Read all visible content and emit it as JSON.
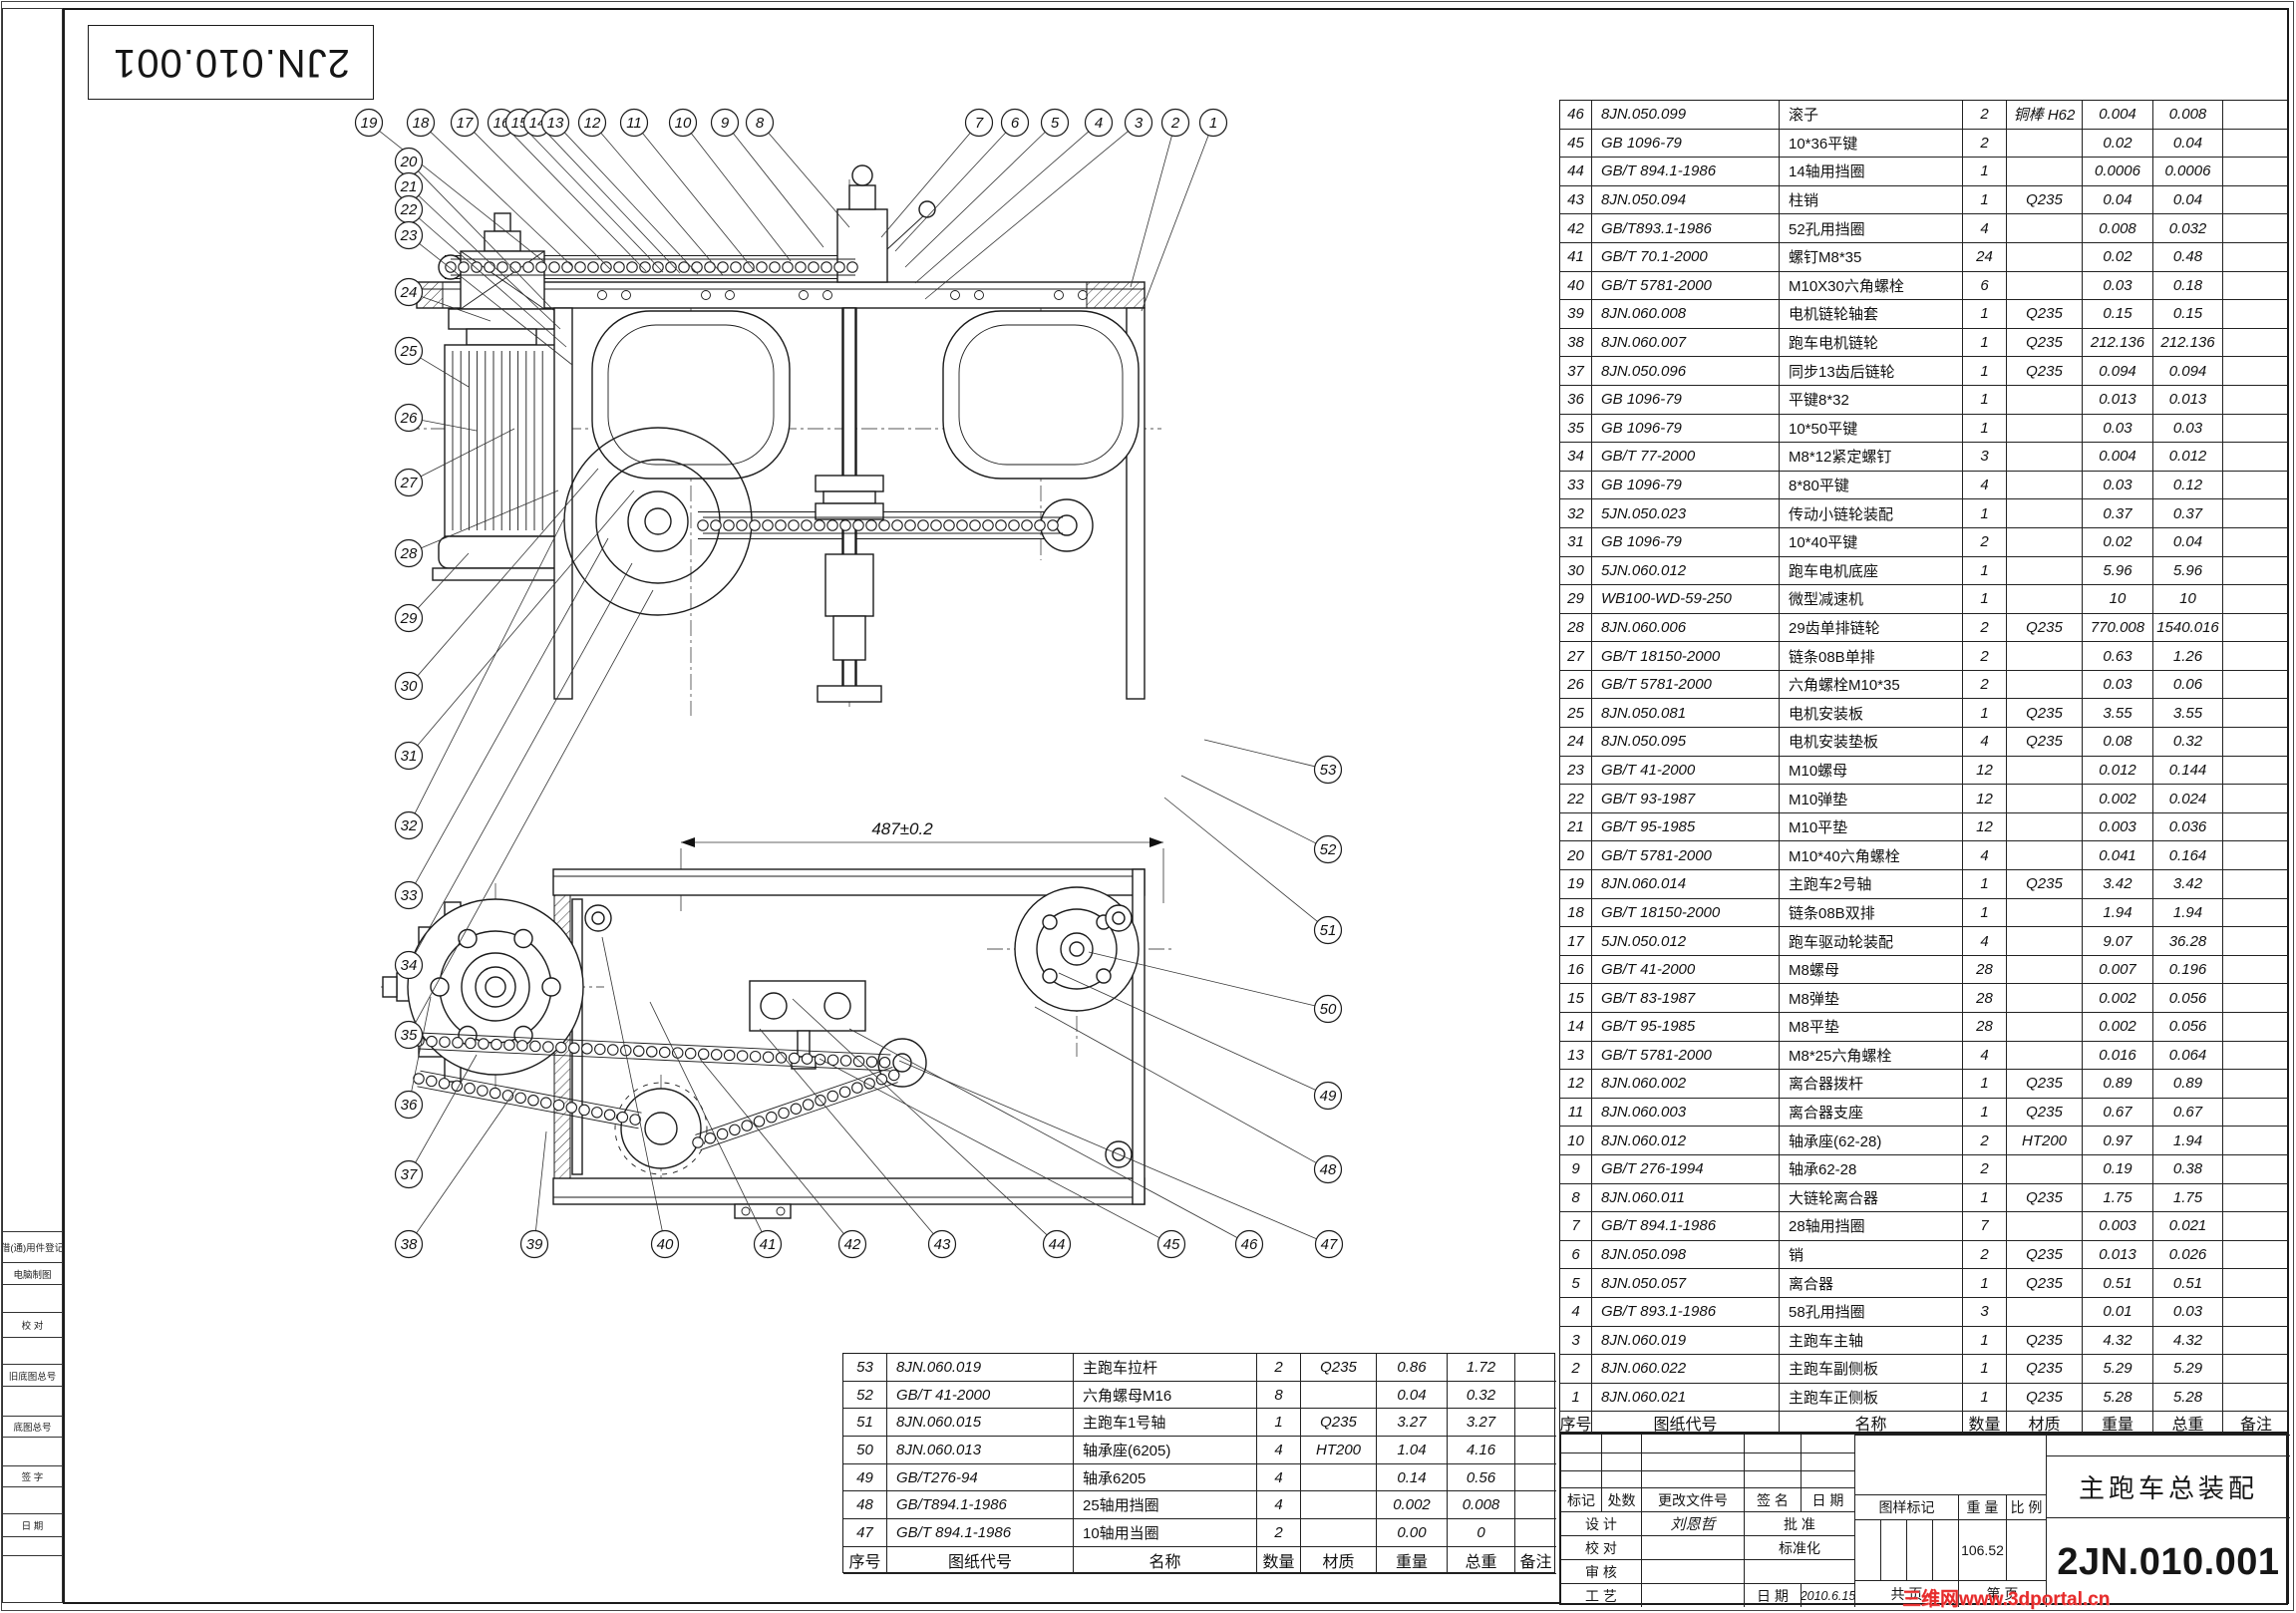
{
  "sheet": {
    "top_left_code": "2JN.010.001",
    "watermark": "三维网www.3dportal.cn"
  },
  "left_margin": {
    "cells": [
      "",
      "借(通)用件登记",
      "电脑制图",
      "",
      "校  对",
      "",
      "旧底图总号",
      "",
      "底图总号",
      "",
      "签  字",
      "",
      "日  期",
      "",
      ""
    ]
  },
  "bom_header": [
    "序号",
    "图纸代号",
    "名称",
    "数量",
    "材质",
    "重量",
    "总重",
    "备注"
  ],
  "bom_right": [
    [
      "46",
      "8JN.050.099",
      "滚子",
      "2",
      "铜棒 H62",
      "0.004",
      "0.008"
    ],
    [
      "45",
      "GB 1096-79",
      "10*36平键",
      "2",
      "",
      "0.02",
      "0.04"
    ],
    [
      "44",
      "GB/T 894.1-1986",
      "14轴用挡圈",
      "1",
      "",
      "0.0006",
      "0.0006"
    ],
    [
      "43",
      "8JN.050.094",
      "柱销",
      "1",
      "Q235",
      "0.04",
      "0.04"
    ],
    [
      "42",
      "GB/T893.1-1986",
      "52孔用挡圈",
      "4",
      "",
      "0.008",
      "0.032"
    ],
    [
      "41",
      "GB/T 70.1-2000",
      "螺钉M8*35",
      "24",
      "",
      "0.02",
      "0.48"
    ],
    [
      "40",
      "GB/T 5781-2000",
      "M10X30六角螺栓",
      "6",
      "",
      "0.03",
      "0.18"
    ],
    [
      "39",
      "8JN.060.008",
      "电机链轮轴套",
      "1",
      "Q235",
      "0.15",
      "0.15"
    ],
    [
      "38",
      "8JN.060.007",
      "跑车电机链轮",
      "1",
      "Q235",
      "212.136",
      "212.136"
    ],
    [
      "37",
      "8JN.050.096",
      "同步13齿后链轮",
      "1",
      "Q235",
      "0.094",
      "0.094"
    ],
    [
      "36",
      "GB  1096-79",
      "平键8*32",
      "1",
      "",
      "0.013",
      "0.013"
    ],
    [
      "35",
      "GB 1096-79",
      "10*50平键",
      "1",
      "",
      "0.03",
      "0.03"
    ],
    [
      "34",
      "GB/T 77-2000",
      "M8*12紧定螺钉",
      "3",
      "",
      "0.004",
      "0.012"
    ],
    [
      "33",
      "GB 1096-79",
      "8*80平键",
      "4",
      "",
      "0.03",
      "0.12"
    ],
    [
      "32",
      "5JN.050.023",
      "传动小链轮装配",
      "1",
      "",
      "0.37",
      "0.37"
    ],
    [
      "31",
      "GB 1096-79",
      "10*40平键",
      "2",
      "",
      "0.02",
      "0.04"
    ],
    [
      "30",
      "5JN.060.012",
      "跑车电机底座",
      "1",
      "",
      "5.96",
      "5.96"
    ],
    [
      "29",
      "WB100-WD-59-250",
      "微型减速机",
      "1",
      "",
      "10",
      "10"
    ],
    [
      "28",
      "8JN.060.006",
      "29齿单排链轮",
      "2",
      "Q235",
      "770.008",
      "1540.016"
    ],
    [
      "27",
      "GB/T 18150-2000",
      "链条08B单排",
      "2",
      "",
      "0.63",
      "1.26"
    ],
    [
      "26",
      "GB/T 5781-2000",
      "六角螺栓M10*35",
      "2",
      "",
      "0.03",
      "0.06"
    ],
    [
      "25",
      "8JN.050.081",
      "电机安装板",
      "1",
      "Q235",
      "3.55",
      "3.55"
    ],
    [
      "24",
      "8JN.050.095",
      "电机安装垫板",
      "4",
      "Q235",
      "0.08",
      "0.32"
    ],
    [
      "23",
      "GB/T 41-2000",
      "M10螺母",
      "12",
      "",
      "0.012",
      "0.144"
    ],
    [
      "22",
      "GB/T 93-1987",
      "M10弹垫",
      "12",
      "",
      "0.002",
      "0.024"
    ],
    [
      "21",
      "GB/T 95-1985",
      "M10平垫",
      "12",
      "",
      "0.003",
      "0.036"
    ],
    [
      "20",
      "GB/T 5781-2000",
      "M10*40六角螺栓",
      "4",
      "",
      "0.041",
      "0.164"
    ],
    [
      "19",
      "8JN.060.014",
      "主跑车2号轴",
      "1",
      "Q235",
      "3.42",
      "3.42"
    ],
    [
      "18",
      "GB/T 18150-2000",
      "链条08B双排",
      "1",
      "",
      "1.94",
      "1.94"
    ],
    [
      "17",
      "5JN.050.012",
      "跑车驱动轮装配",
      "4",
      "",
      "9.07",
      "36.28"
    ],
    [
      "16",
      "GB/T 41-2000",
      "M8螺母",
      "28",
      "",
      "0.007",
      "0.196"
    ],
    [
      "15",
      "GB/T 83-1987",
      "M8弹垫",
      "28",
      "",
      "0.002",
      "0.056"
    ],
    [
      "14",
      "GB/T 95-1985",
      "M8平垫",
      "28",
      "",
      "0.002",
      "0.056"
    ],
    [
      "13",
      "GB/T 5781-2000",
      "M8*25六角螺栓",
      "4",
      "",
      "0.016",
      "0.064"
    ],
    [
      "12",
      "8JN.060.002",
      "离合器拨杆",
      "1",
      "Q235",
      "0.89",
      "0.89"
    ],
    [
      "11",
      "8JN.060.003",
      "离合器支座",
      "1",
      "Q235",
      "0.67",
      "0.67"
    ],
    [
      "10",
      "8JN.060.012",
      "轴承座(62-28)",
      "2",
      "HT200",
      "0.97",
      "1.94"
    ],
    [
      "9",
      "GB/T 276-1994",
      "轴承62-28",
      "2",
      "",
      "0.19",
      "0.38"
    ],
    [
      "8",
      "8JN.060.011",
      "大链轮离合器",
      "1",
      "Q235",
      "1.75",
      "1.75"
    ],
    [
      "7",
      "GB/T 894.1-1986",
      "28轴用挡圈",
      "7",
      "",
      "0.003",
      "0.021"
    ],
    [
      "6",
      "8JN.050.098",
      "销",
      "2",
      "Q235",
      "0.013",
      "0.026"
    ],
    [
      "5",
      "8JN.050.057",
      "离合器",
      "1",
      "Q235",
      "0.51",
      "0.51"
    ],
    [
      "4",
      "GB/T 893.1-1986",
      "58孔用挡圈",
      "3",
      "",
      "0.01",
      "0.03"
    ],
    [
      "3",
      "8JN.060.019",
      "主跑车主轴",
      "1",
      "Q235",
      "4.32",
      "4.32"
    ],
    [
      "2",
      "8JN.060.022",
      "主跑车副侧板",
      "1",
      "Q235",
      "5.29",
      "5.29"
    ],
    [
      "1",
      "8JN.060.021",
      "主跑车正侧板",
      "1",
      "Q235",
      "5.28",
      "5.28"
    ]
  ],
  "bom_bottom": [
    [
      "53",
      "8JN.060.019",
      "主跑车拉杆",
      "2",
      "Q235",
      "0.86",
      "1.72"
    ],
    [
      "52",
      "GB/T 41-2000",
      "六角螺母M16",
      "8",
      "",
      "0.04",
      "0.32"
    ],
    [
      "51",
      "8JN.060.015",
      "主跑车1号轴",
      "1",
      "Q235",
      "3.27",
      "3.27"
    ],
    [
      "50",
      "8JN.060.013",
      "轴承座(6205)",
      "4",
      "HT200",
      "1.04",
      "4.16"
    ],
    [
      "49",
      "GB/T276-94",
      "轴承6205",
      "4",
      "",
      "0.14",
      "0.56"
    ],
    [
      "48",
      "GB/T894.1-1986",
      "25轴用挡圈",
      "4",
      "",
      "0.002",
      "0.008"
    ],
    [
      "47",
      "GB/T 894.1-1986",
      "10轴用当圈",
      "2",
      "",
      "0.00",
      "0"
    ]
  ],
  "title_block": {
    "mark": "标记",
    "qty": "处数",
    "change_doc": "更改文件号",
    "sign": "签  名",
    "date_h": "日  期",
    "design": "设 计",
    "designer": "刘恩哲",
    "approve": "批 准",
    "check": "校 对",
    "standardize": "标准化",
    "audit": "审 核",
    "craft": "工 艺",
    "date_l": "日 期",
    "date_value": "2010.6.15",
    "pattern_mark": "图样标记",
    "weight_l": "重 量",
    "scale_l": "比 例",
    "weight": "106.52",
    "pages_total": "共   页",
    "pages_no": "第   页",
    "title": "主跑车总装配",
    "code": "2JN.010.001"
  },
  "drawing": {
    "dimension": "487±0.2",
    "callouts": [
      [
        19,
        370,
        123,
        545,
        262
      ],
      [
        18,
        422,
        123,
        575,
        268
      ],
      [
        17,
        466,
        123,
        612,
        270
      ],
      [
        16,
        503,
        123,
        648,
        272
      ],
      [
        15,
        521,
        123,
        665,
        273
      ],
      [
        14,
        539,
        123,
        682,
        274
      ],
      [
        13,
        557,
        123,
        700,
        275
      ],
      [
        12,
        594,
        123,
        725,
        276
      ],
      [
        11,
        636,
        123,
        757,
        272
      ],
      [
        10,
        685,
        123,
        793,
        262
      ],
      [
        9,
        727,
        123,
        826,
        248
      ],
      [
        8,
        762,
        123,
        852,
        228
      ],
      [
        7,
        982,
        123,
        884,
        238
      ],
      [
        6,
        1018,
        123,
        898,
        252
      ],
      [
        5,
        1058,
        123,
        908,
        268
      ],
      [
        4,
        1102,
        123,
        918,
        284
      ],
      [
        3,
        1142,
        123,
        928,
        300
      ],
      [
        2,
        1179,
        123,
        1134,
        288
      ],
      [
        1,
        1217,
        123,
        1145,
        312
      ],
      [
        20,
        410,
        162,
        556,
        312
      ],
      [
        21,
        410,
        187,
        562,
        330
      ],
      [
        22,
        410,
        210,
        568,
        348
      ],
      [
        23,
        410,
        236,
        574,
        366
      ],
      [
        24,
        410,
        293,
        492,
        322
      ],
      [
        25,
        410,
        352,
        470,
        388
      ],
      [
        26,
        410,
        419,
        478,
        432
      ],
      [
        27,
        410,
        484,
        516,
        430
      ],
      [
        28,
        410,
        555,
        560,
        492
      ],
      [
        29,
        410,
        620,
        470,
        555
      ],
      [
        30,
        410,
        688,
        600,
        470
      ],
      [
        31,
        410,
        758,
        636,
        492
      ],
      [
        32,
        410,
        828,
        566,
        520
      ],
      [
        33,
        410,
        898,
        610,
        540
      ],
      [
        34,
        410,
        968,
        634,
        565
      ],
      [
        35,
        410,
        1038,
        655,
        592
      ],
      [
        36,
        410,
        1108,
        432,
        1000
      ],
      [
        37,
        410,
        1178,
        478,
        1058
      ],
      [
        38,
        410,
        1248,
        518,
        1092
      ],
      [
        39,
        536,
        1248,
        548,
        1135
      ],
      [
        40,
        667,
        1248,
        604,
        940
      ],
      [
        41,
        770,
        1248,
        652,
        1005
      ],
      [
        42,
        855,
        1248,
        702,
        1062
      ],
      [
        43,
        945,
        1248,
        762,
        1032
      ],
      [
        44,
        1060,
        1248,
        795,
        1002
      ],
      [
        45,
        1175,
        1248,
        822,
        1062
      ],
      [
        46,
        1253,
        1248,
        852,
        1032
      ],
      [
        47,
        1333,
        1248,
        902,
        1064
      ],
      [
        48,
        1332,
        1173,
        1038,
        1010
      ],
      [
        49,
        1332,
        1099,
        1062,
        976
      ],
      [
        50,
        1332,
        1012,
        1092,
        955
      ],
      [
        51,
        1332,
        933,
        1168,
        800
      ],
      [
        52,
        1332,
        852,
        1185,
        778
      ],
      [
        53,
        1332,
        772,
        1208,
        742
      ]
    ]
  }
}
